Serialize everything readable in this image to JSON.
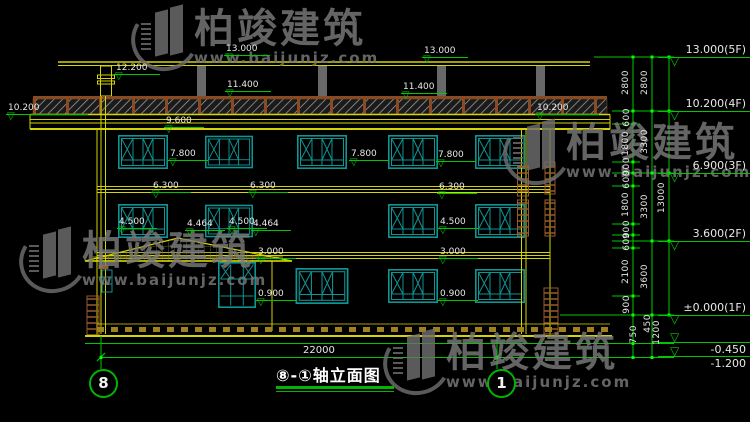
{
  "watermark": {
    "brand": "柏竣建筑",
    "url": "www.baijunjz.com"
  },
  "title": {
    "text": "⑧-①轴立面图"
  },
  "axes": {
    "left_bubble": "8",
    "right_bubble": "1"
  },
  "icons": {
    "elev_triangle": "▽"
  },
  "dims": {
    "overall_width": "22000",
    "col1": [
      "2800",
      "600",
      "1800",
      "900",
      "600",
      "1800",
      "900",
      "600",
      "2100",
      "900",
      "750"
    ],
    "col2": [
      "2800",
      "3300",
      "3300",
      "3600",
      "450",
      "1200"
    ],
    "col3": [
      "13000"
    ]
  },
  "levels": [
    "13.000(5F)",
    "10.200(4F)",
    "6.900(3F)",
    "3.600(2F)",
    "±0.000(1F)",
    "-0.450",
    "-1.200"
  ],
  "marks": [
    "13.000",
    "13.000",
    "12.200",
    "11.400",
    "11.400",
    "10.200",
    "10.200",
    "9.600",
    "7.800",
    "7.800",
    "7.800",
    "6.300",
    "6.300",
    "6.300",
    "4.500",
    "4.464",
    "4.500",
    "4.464",
    "4.500",
    "3.000",
    "3.000",
    "0.900",
    "0.900"
  ],
  "colors": {
    "line_yellow": "#d4d404",
    "window_teal": "#0f9494",
    "dim_green": "#00c800",
    "hatch_brown": "#8b4a21",
    "watermark_gray": "#6e6e6e",
    "background": "#000000"
  }
}
